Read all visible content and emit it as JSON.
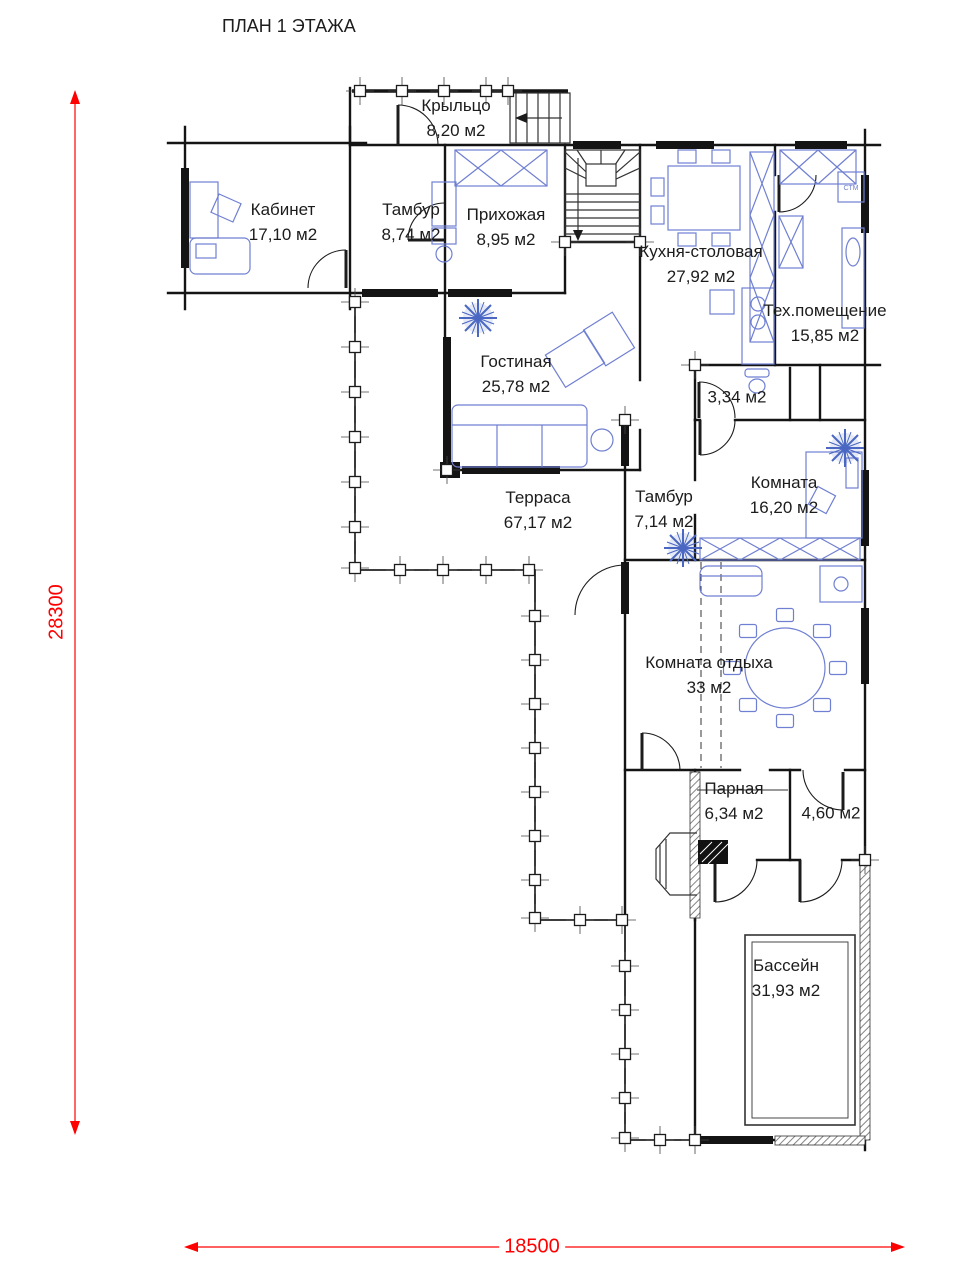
{
  "title": "ПЛАН 1 ЭТАЖА",
  "dimensions": {
    "vertical": "28300",
    "horizontal": "18500"
  },
  "rooms": [
    {
      "id": "porch",
      "name": "Крыльцо",
      "area": "8,20 м2"
    },
    {
      "id": "cabinet",
      "name": "Кабинет",
      "area": "17,10 м2"
    },
    {
      "id": "tambour1",
      "name": "Тамбур",
      "area": "8,74 м2"
    },
    {
      "id": "hallway",
      "name": "Прихожая",
      "area": "8,95 м2"
    },
    {
      "id": "kitchen",
      "name": "Кухня-столовая",
      "area": "27,92 м2"
    },
    {
      "id": "tech",
      "name": "Тех.помещение",
      "area": "15,85 м2"
    },
    {
      "id": "living",
      "name": "Гостиная",
      "area": "25,78 м2"
    },
    {
      "id": "wc",
      "name": "",
      "area": "3,34 м2"
    },
    {
      "id": "room",
      "name": "Комната",
      "area": "16,20 м2"
    },
    {
      "id": "tambour2",
      "name": "Тамбур",
      "area": "7,14 м2"
    },
    {
      "id": "terrace",
      "name": "Терраса",
      "area": "67,17 м2"
    },
    {
      "id": "lounge",
      "name": "Комната отдыха",
      "area": "33 м2"
    },
    {
      "id": "sauna",
      "name": "Парная",
      "area": "6,34 м2"
    },
    {
      "id": "shower",
      "name": "",
      "area": "4,60 м2"
    },
    {
      "id": "pool",
      "name": "Бассейн",
      "area": "31,93 м2"
    }
  ],
  "labels": {
    "washer": "СТМ"
  },
  "colors": {
    "wall": "#141414",
    "furniture": "#6f7fd2",
    "snowflake": "#4a67c2",
    "dimension": "#ff0000"
  }
}
